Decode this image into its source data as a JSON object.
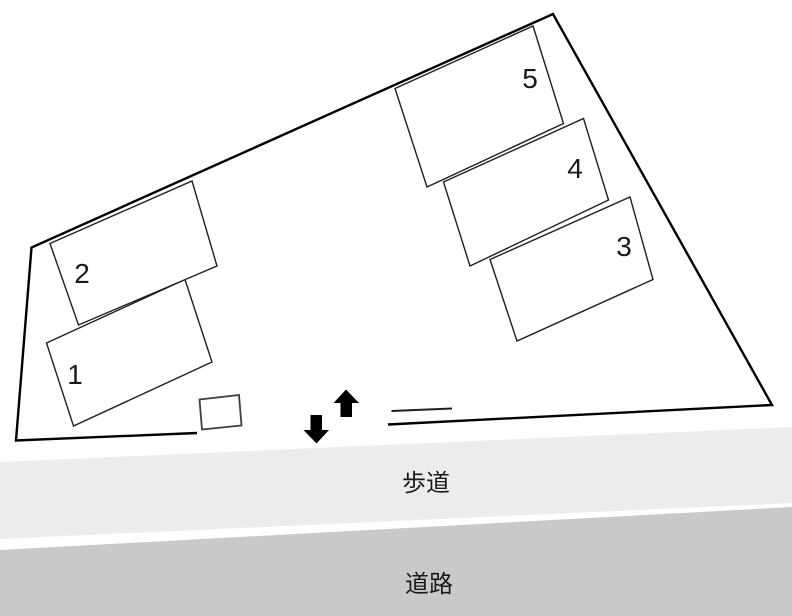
{
  "parking_spaces": [
    {
      "label": "1"
    },
    {
      "label": "2"
    },
    {
      "label": "3"
    },
    {
      "label": "4"
    },
    {
      "label": "5"
    }
  ],
  "zones": {
    "sidewalk_label": "歩道",
    "road_label": "道路"
  },
  "icons": {
    "up_arrow": "up-arrow-icon",
    "down_arrow": "down-arrow-icon"
  },
  "colors": {
    "sidewalk_fill": "#ececec",
    "road_fill": "#c9c9c9",
    "boundary_stroke": "#000000",
    "arrow_fill": "#000000"
  }
}
